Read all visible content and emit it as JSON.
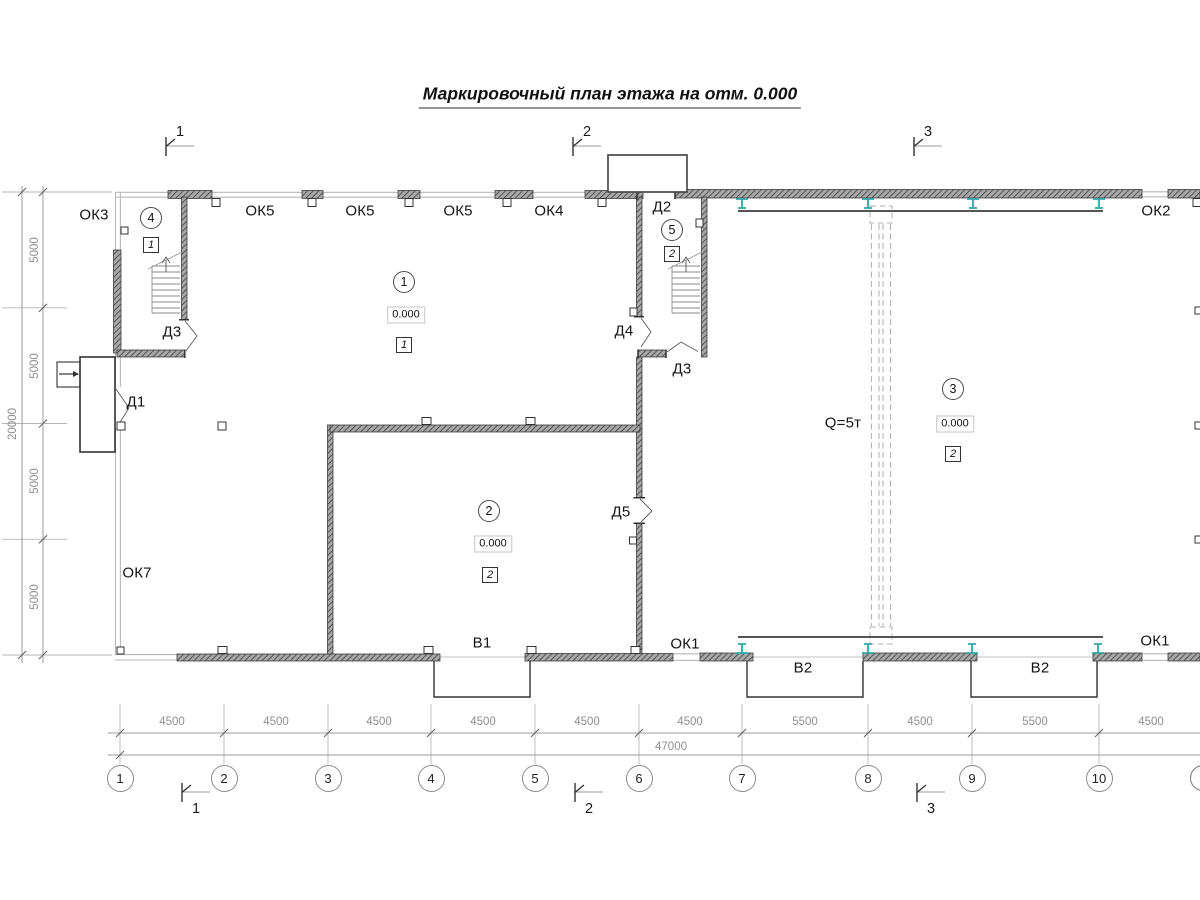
{
  "title": "Маркировочный план этажа на отм. 0.000",
  "sections": {
    "top": [
      "1",
      "2",
      "3"
    ],
    "bottom": [
      "1",
      "2",
      "3"
    ]
  },
  "grid": {
    "bubbles": [
      "1",
      "2",
      "3",
      "4",
      "5",
      "6",
      "7",
      "8",
      "9",
      "10"
    ]
  },
  "dimensions": {
    "bottom_segments": [
      "4500",
      "4500",
      "4500",
      "4500",
      "4500",
      "4500",
      "5500",
      "4500",
      "5500",
      "4500"
    ],
    "bottom_total": "47000",
    "left_segments": [
      "5000",
      "5000",
      "5000",
      "5000"
    ],
    "left_total": "20000"
  },
  "rooms": [
    {
      "number": "1",
      "elevation": "0.000",
      "type": "1"
    },
    {
      "number": "2",
      "elevation": "0.000",
      "type": "2"
    },
    {
      "number": "3",
      "elevation": "0.000",
      "type": "2"
    },
    {
      "number": "4",
      "type": "1"
    },
    {
      "number": "5",
      "type": "2"
    }
  ],
  "labels": {
    "windows": [
      "ОК3",
      "ОК5",
      "ОК5",
      "ОК5",
      "ОК4",
      "ОК2",
      "ОК7",
      "ОК1",
      "ОК1"
    ],
    "doors": [
      "Д1",
      "Д2",
      "Д3",
      "Д3",
      "Д4",
      "Д5"
    ],
    "gates": [
      "В1",
      "В2",
      "В2"
    ],
    "crane": "Q=5т"
  },
  "colors": {
    "wall": "#3c3c3c",
    "window_band": "#b8b8b8",
    "column_steel": "#2fa8a8",
    "dimension": "#8f8f8f"
  }
}
